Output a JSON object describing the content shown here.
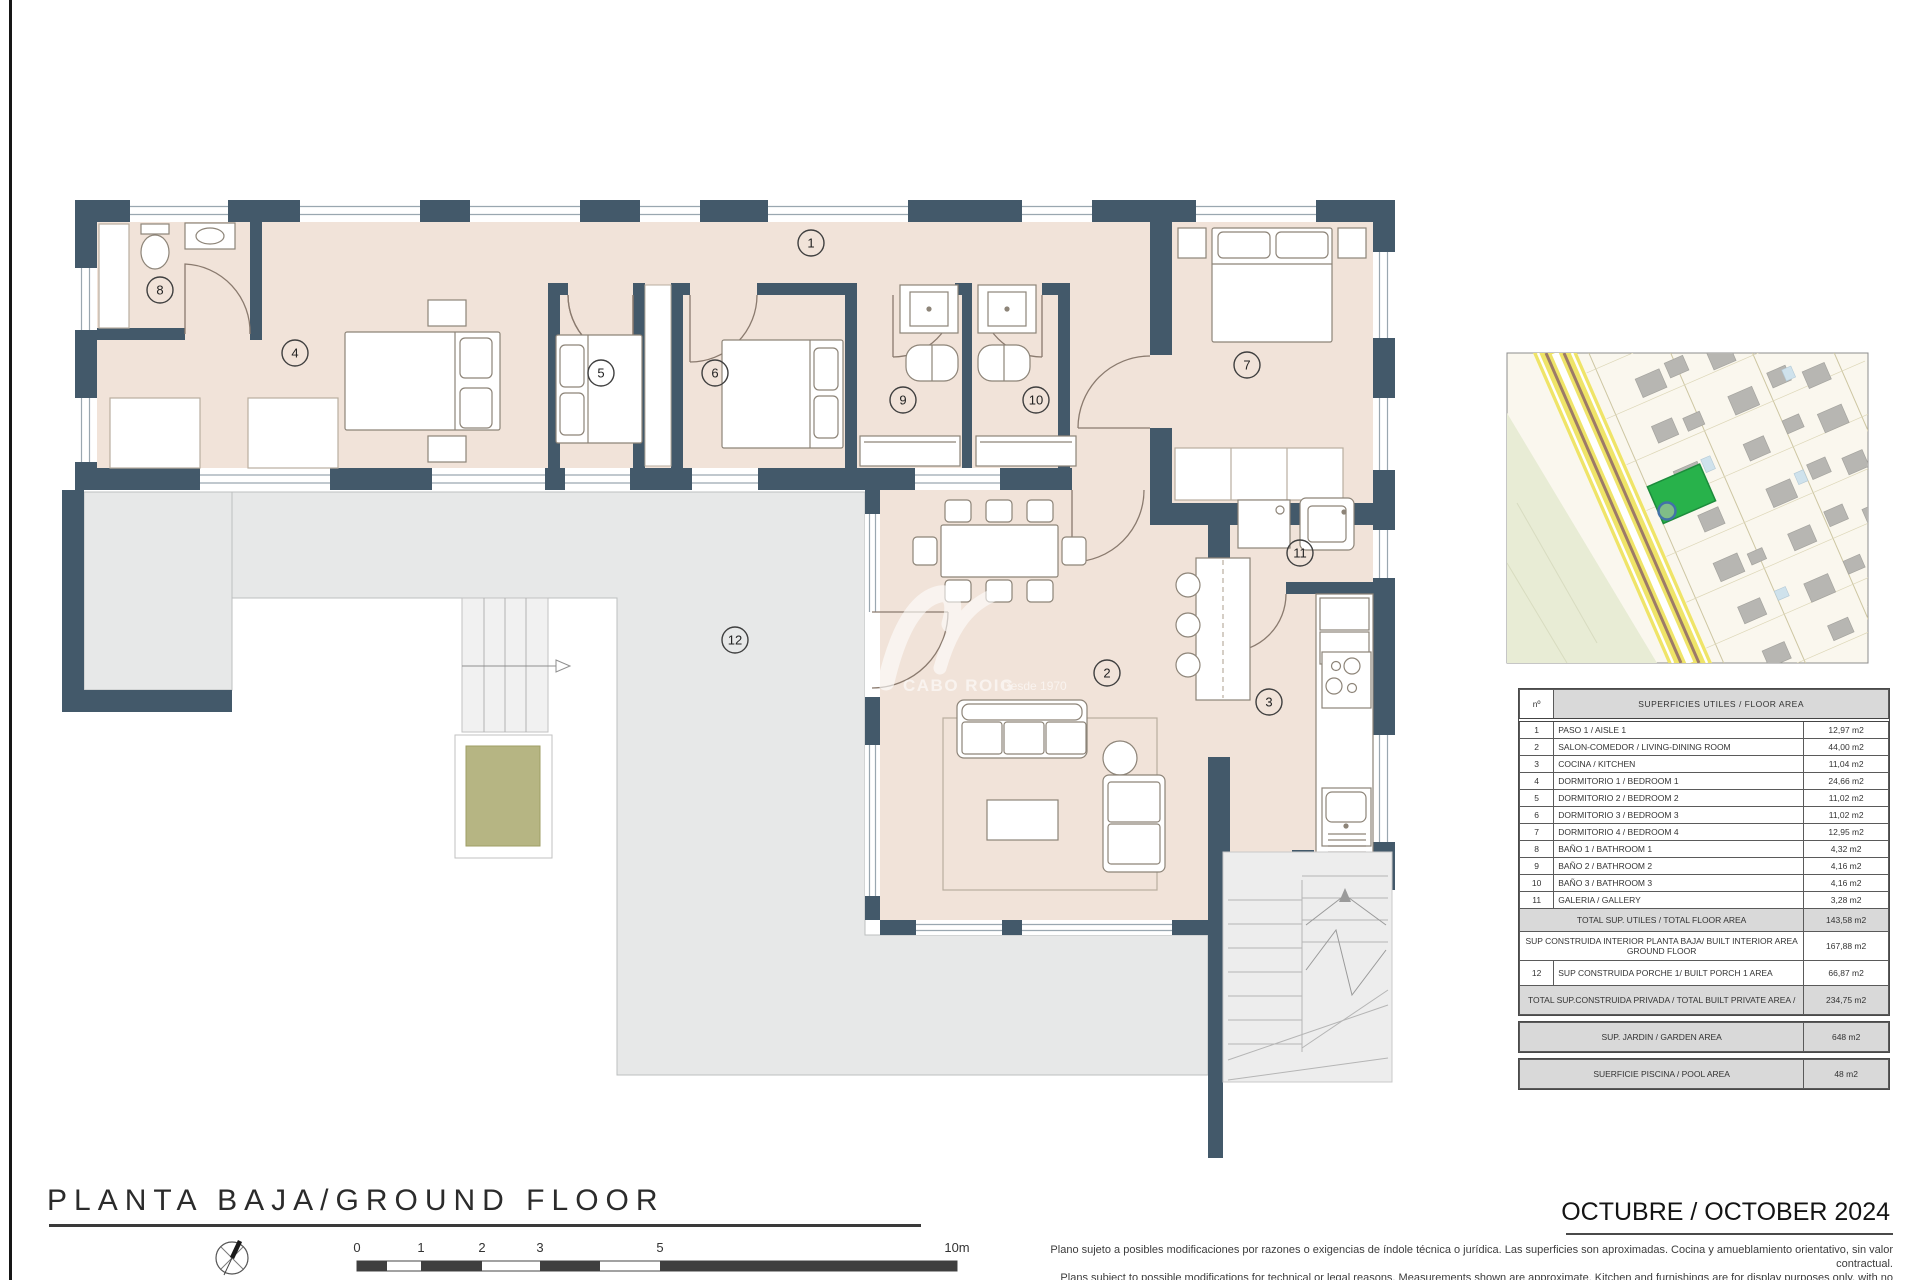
{
  "header": {
    "title": "PLANTA BAJA/GROUND FLOOR",
    "date": "OCTUBRE / OCTOBER 2024"
  },
  "watermark": {
    "brand": "CABO ROIG",
    "tagline": "Desde 1970"
  },
  "plan": {
    "room_labels": [
      "1",
      "2",
      "3",
      "4",
      "5",
      "6",
      "7",
      "8",
      "9",
      "10",
      "11",
      "12"
    ]
  },
  "scale": {
    "labels": [
      "0",
      "1",
      "2",
      "3",
      "5",
      "10m"
    ]
  },
  "table": {
    "header": {
      "num": "nº",
      "title": "SUPERFICIES UTILES  / FLOOR AREA"
    },
    "rows": [
      {
        "num": "1",
        "label": "PASO 1 / AISLE 1",
        "area": "12,97 m2"
      },
      {
        "num": "2",
        "label": "SALON-COMEDOR /  LIVING-DINING ROOM",
        "area": "44,00 m2"
      },
      {
        "num": "3",
        "label": "COCINA / KITCHEN",
        "area": "11,04 m2"
      },
      {
        "num": "4",
        "label": "DORMITORIO 1 / BEDROOM 1",
        "area": "24,66 m2"
      },
      {
        "num": "5",
        "label": "DORMITORIO 2 / BEDROOM 2",
        "area": "11,02 m2"
      },
      {
        "num": "6",
        "label": "DORMITORIO 3 / BEDROOM 3",
        "area": "11,02 m2"
      },
      {
        "num": "7",
        "label": "DORMITORIO 4 / BEDROOM 4",
        "area": "12,95 m2"
      },
      {
        "num": "8",
        "label": "BAÑO 1 / BATHROOM 1",
        "area": "4,32 m2"
      },
      {
        "num": "9",
        "label": "BAÑO 2 / BATHROOM 2",
        "area": "4,16 m2"
      },
      {
        "num": "10",
        "label": "BAÑO 3 / BATHROOM 3",
        "area": "4,16 m2"
      },
      {
        "num": "11",
        "label": "GALERIA / GALLERY",
        "area": "3,28 m2"
      }
    ],
    "summary": {
      "total_utiles": {
        "label": "TOTAL SUP. UTILES / TOTAL FLOOR AREA",
        "area": "143,58 m2"
      },
      "built_interior": {
        "label": "SUP CONSTRUIDA INTERIOR PLANTA BAJA/ BUILT INTERIOR AREA GROUND FLOOR",
        "area": "167,88 m2"
      },
      "porch": {
        "num": "12",
        "label": "SUP CONSTRUIDA PORCHE 1/ BUILT PORCH 1 AREA",
        "area": "66,87 m2"
      },
      "total_private": {
        "label": "TOTAL SUP.CONSTRUIDA PRIVADA / TOTAL  BUILT PRIVATE AREA /",
        "area": "234,75 m2"
      },
      "garden": {
        "label": "SUP. JARDIN / GARDEN AREA",
        "area": "648 m2"
      },
      "pool": {
        "label": "SUERFICIE PISCINA / POOL AREA",
        "area": "48 m2"
      }
    }
  },
  "disclaimer": {
    "line1": "Plano sujeto a posibles modificaciones por razones o exigencias de índole técnica o jurídica. Las superficies son aproximadas. Cocina y amueblamiento orientativo, sin valor contractual.",
    "line2": "Plans subject to possible modifications for technical or legal reasons. Measurements shown are approximate. Kitchen and furnishings are for display purposes only, with no contractual value."
  },
  "colors": {
    "wall": "#43596a",
    "floor": "#f1e3d9",
    "porch": "#e7e8e8",
    "planter": "#b6b583",
    "map_plot_green": "#28b24b"
  }
}
